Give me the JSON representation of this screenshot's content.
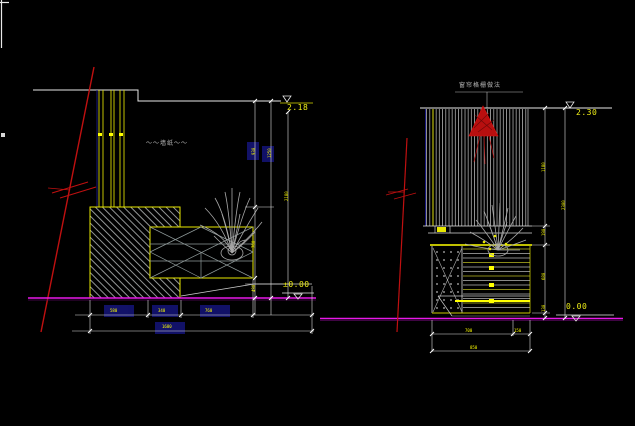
{
  "app": {
    "type": "cad-viewer-drawing",
    "background": "#000000",
    "palette": {
      "line_white": "#e8e8e8",
      "line_gray": "#aaaaaa",
      "accent_yellow": "#ffff00",
      "section_red": "#c01010",
      "floor_magenta": "#ee18ee",
      "artifact_blue": "#15157a"
    }
  },
  "left_elevation": {
    "level_top": "2.18",
    "level_bottom": "±0.00",
    "wall_note": "〜〜墙纸〜〜",
    "dims": {
      "bottom_row1": [
        "580",
        "340",
        "760"
      ],
      "bottom_row2": "1680",
      "right_col1": [
        "930",
        "760",
        "490"
      ],
      "right_col2": "1250",
      "right_col3": "2180"
    }
  },
  "right_elevation": {
    "top_note": "窗帘格栅做法",
    "level_top": "2.30",
    "level_bottom": "0.00",
    "dims": {
      "bottom_row1": [
        "700",
        "150"
      ],
      "bottom_row2": "850",
      "right_col1": [
        "1180",
        "190",
        "680",
        "130"
      ],
      "right_col2": "2300"
    }
  }
}
